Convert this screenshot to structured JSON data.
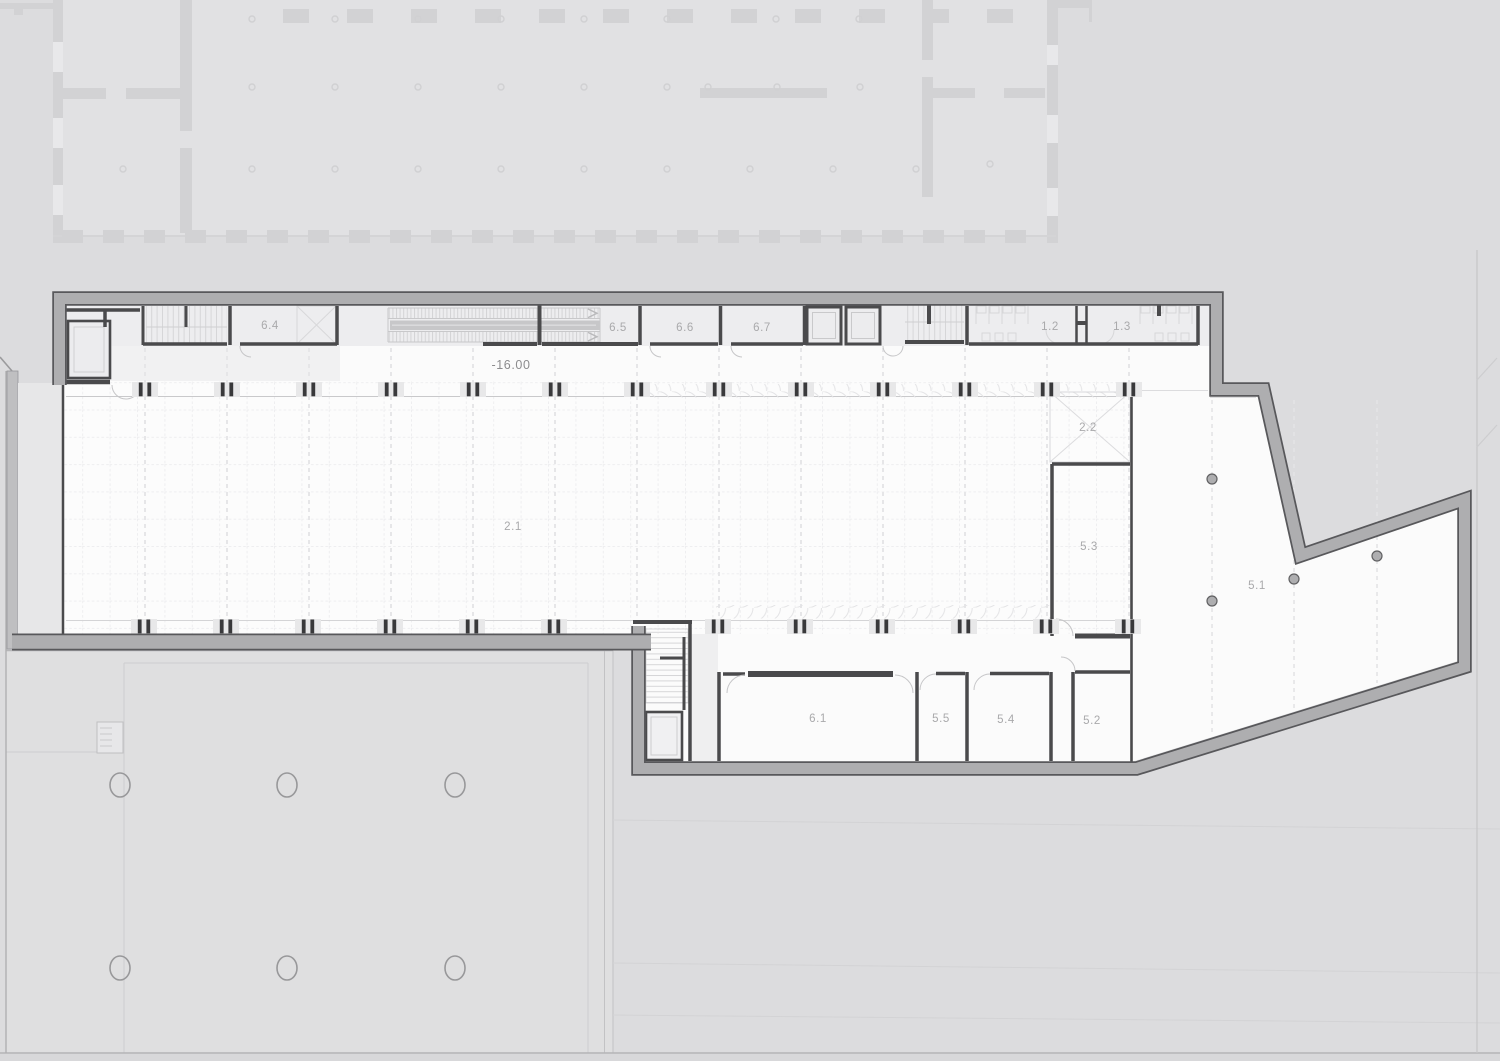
{
  "level_marker": "-16.00",
  "rooms": [
    {
      "label": "6.4"
    },
    {
      "label": "6.5"
    },
    {
      "label": "6.6"
    },
    {
      "label": "6.7"
    },
    {
      "label": "1.2"
    },
    {
      "label": "1.3"
    },
    {
      "label": "2.1"
    },
    {
      "label": "2.2"
    },
    {
      "label": "5.3"
    },
    {
      "label": "5.1"
    },
    {
      "label": "6.1"
    },
    {
      "label": "5.5"
    },
    {
      "label": "5.4"
    },
    {
      "label": "5.2"
    }
  ],
  "symbols": {
    "stairs": "stairs",
    "escalator": "escalator",
    "elevator": "elevator",
    "column": "structural-column"
  },
  "colors": {
    "background": "#dcdcde",
    "site_area": "#dfdfe0",
    "wall_fill": "#aeaeb0",
    "wall_edge": "#58585b",
    "partition": "#4a4a4c",
    "hall_floor": "#fbfbfb",
    "room_band_floor": "#ededef",
    "grid_line": "#eeeef0",
    "faint_plan": "#d2d2d4",
    "label_text": "#a9a9ab",
    "level_text": "#8c8c8e"
  }
}
